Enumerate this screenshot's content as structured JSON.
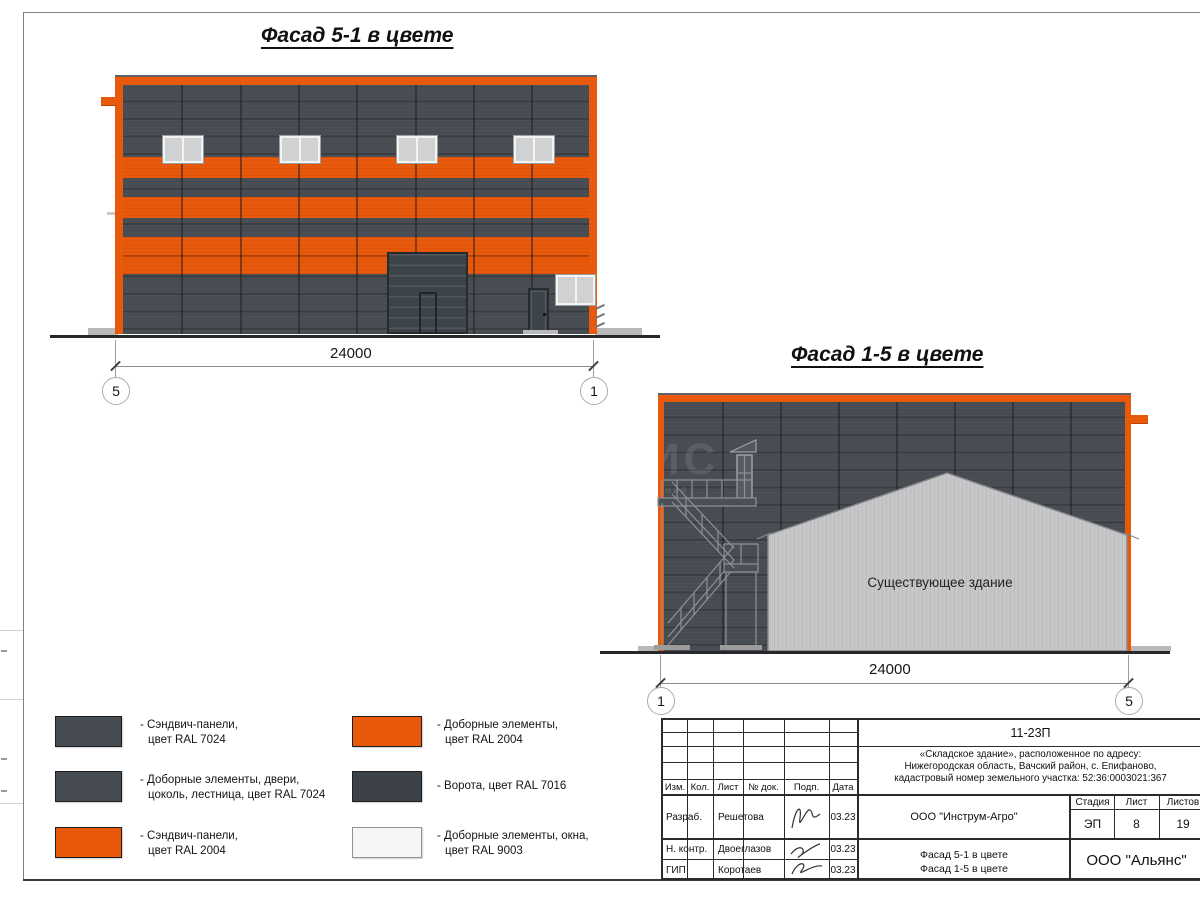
{
  "sheet": {
    "facade51_title": "Фасад 5-1 в цвете",
    "facade15_title": "Фасад 1-5 в цвете",
    "existing_building_label": "Существующее здание",
    "watermark_large": "ИС",
    "watermark_small": "ания"
  },
  "dimensions": {
    "facade51": {
      "value": "24000",
      "axis_left": "5",
      "axis_right": "1"
    },
    "facade15": {
      "value": "24000",
      "axis_left": "1",
      "axis_right": "5"
    }
  },
  "colors": {
    "ral7024": "#474c52",
    "ral2004": "#e8590b",
    "ral7016": "#3b4146",
    "ral9003": "#f6f6f4"
  },
  "legend": {
    "items": [
      {
        "line1": "- Сэндвич-панели,",
        "line2": "цвет RAL 7024",
        "color": "#474c52"
      },
      {
        "line1": "- Доборные элементы, двери,",
        "line2": "цоколь, лестница, цвет RAL 7024",
        "color": "#474c52"
      },
      {
        "line1": "- Сэндвич-панели,",
        "line2": "цвет RAL 2004",
        "color": "#e8590b"
      },
      {
        "line1": "- Доборные элементы,",
        "line2": "цвет RAL 2004",
        "color": "#e8590b"
      },
      {
        "line1": "- Ворота, цвет RAL 7016",
        "line2": "",
        "color": "#3b4146"
      },
      {
        "line1": "- Доборные элементы, окна,",
        "line2": "цвет RAL 9003",
        "color": "#f6f6f4"
      }
    ]
  },
  "title_block": {
    "doc_number": "11-23П",
    "project_line1": "«Складское здание», расположенное по адресу:",
    "project_line2": "Нижегородская область, Вачский район, с. Епифаново,",
    "project_line3": "кадастровый номер земельного участка: 52:36:0003021:367",
    "headers": {
      "izm": "Изм.",
      "kol": "Кол.",
      "list": "Лист",
      "doc": "№ док.",
      "podp": "Подп.",
      "data": "Дата"
    },
    "rows": [
      {
        "role": "Разраб.",
        "name": "Решетова",
        "date": "03.23"
      },
      {
        "role": "Н. контр.",
        "name": "Двоеглазов",
        "date": "03.23"
      },
      {
        "role": "ГИП",
        "name": "Коротаев",
        "date": "03.23"
      }
    ],
    "org": "ООО \"Инструм-Агро\"",
    "stage_header": "Стадия",
    "sheet_header": "Лист",
    "sheets_header": "Листов",
    "stage": "ЭП",
    "sheet_no": "8",
    "sheets_total": "19",
    "drawing_name_line1": "Фасад 5-1 в цвете",
    "drawing_name_line2": "Фасад 1-5 в цвете",
    "company": "ООО \"Альянс\""
  }
}
